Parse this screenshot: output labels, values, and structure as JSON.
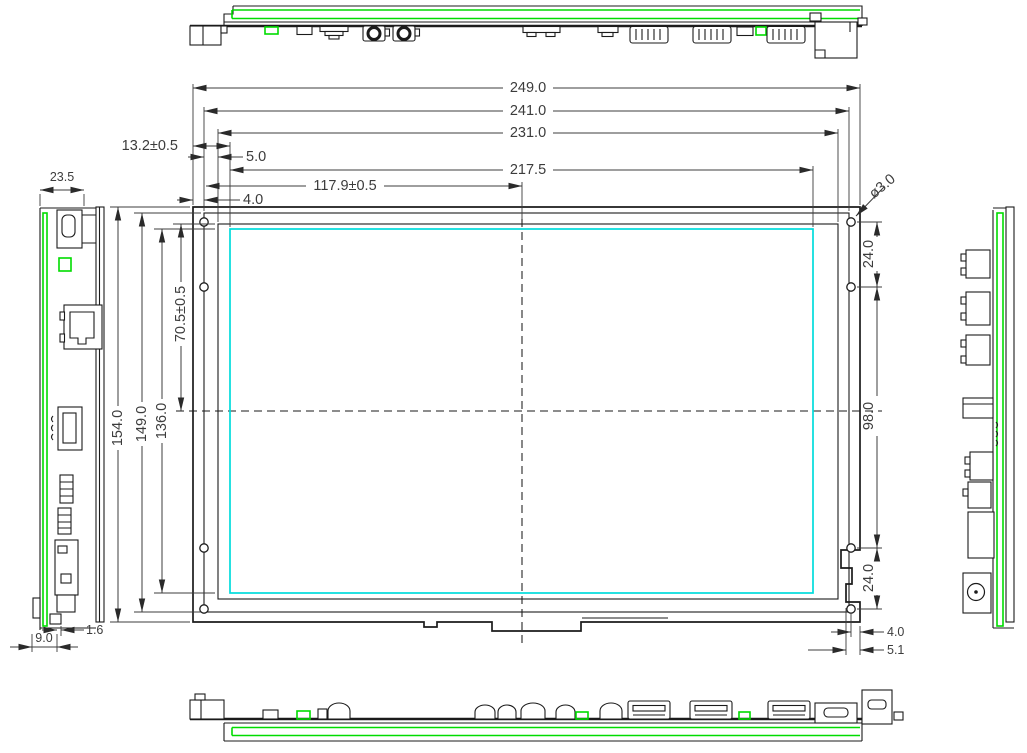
{
  "drawing": {
    "colors": {
      "outline": "#1b1b1b",
      "pcb_outline": "#00dc00",
      "active_area": "#00dcdc",
      "dimension_text": "#3c3c3c"
    },
    "dims": {
      "w_overall": "249.0",
      "w_module": "241.0",
      "w_bezel": "231.0",
      "w_active": "217.5",
      "w_center": "117.9±0.5",
      "edge_to_active": "13.2±0.5",
      "bezel_offset": "5.0",
      "hole_offset_top": "4.0",
      "h_overall": "154.0",
      "h_module": "149.0",
      "h_active": "136.0",
      "v_center": "70.5±0.5",
      "side_thickness": "23.5",
      "pcb_thickness": "1.6",
      "connector_protrusion": "9.0",
      "hole_diameter": "ø3.0",
      "hole_pitch_top": "24.0",
      "hole_pitch_middle": "98.0",
      "hole_pitch_bottom": "24.0",
      "hole_offset_right": "4.0",
      "notch_offset": "5.1"
    }
  }
}
